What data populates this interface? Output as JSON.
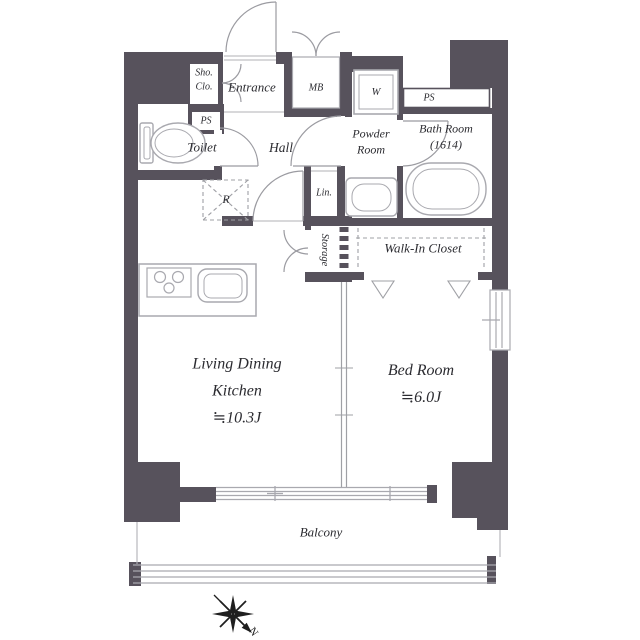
{
  "plan": {
    "type_note": "1LDK apartment floor plan",
    "colors": {
      "wall": "#57525C",
      "fixture_line": "#A9A9AF",
      "text": "#2B2B30"
    },
    "rooms": {
      "sho_clo": {
        "label": "Sho.\nClo."
      },
      "entrance": {
        "label": "Entrance"
      },
      "mb": {
        "label": "MB"
      },
      "w": {
        "label": "W"
      },
      "ps_left": {
        "label": "PS"
      },
      "ps_right": {
        "label": "PS"
      },
      "toilet": {
        "label": "Toilet"
      },
      "hall": {
        "label": "Hall"
      },
      "powder_room": {
        "label": "Powder\nRoom"
      },
      "bath_room": {
        "label": "Bath Room\n(1614)"
      },
      "lin": {
        "label": "Lin."
      },
      "storage": {
        "label": "Storage"
      },
      "walk_in_closet": {
        "label": "Walk-In Closet"
      },
      "refrigerator": {
        "label": "R"
      },
      "ldk": {
        "label": "Living Dining\nKitchen\n≒10.3J"
      },
      "bedroom": {
        "label": "Bed Room\n≒6.0J"
      },
      "balcony": {
        "label": "Balcony"
      }
    },
    "compass": {
      "north_label": "N"
    }
  }
}
